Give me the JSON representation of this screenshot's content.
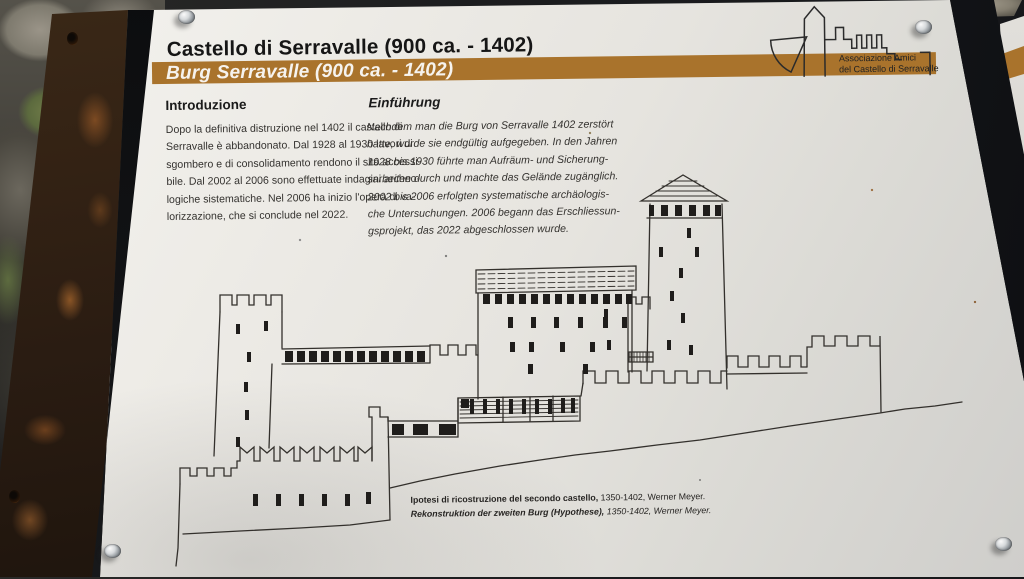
{
  "colors": {
    "accent_brown": "#a9732c",
    "panel_white": "#eceae5",
    "ink": "#1b1b1b"
  },
  "header": {
    "title_italian": "Castello di Serravalle (900 ca. - 1402)",
    "title_german": "Burg Serravalle (900 ca. - 1402)"
  },
  "logo": {
    "line1": "Associazione Amici",
    "line2": "del Castello di Serravalle"
  },
  "intro_it": {
    "heading": "Introduzione",
    "lines": [
      "Dopo la definitiva distruzione nel 1402 il castello di",
      "Serravalle è abbandonato. Dal 1928 al 1930 lavori di",
      "sgombero e di consolidamento rendono il sito accessi-",
      "bile. Dal 2002 al 2006 sono effettuate indagini archeo-",
      "logiche sistematiche. Nel 2006 ha inizio l'opera di va-",
      "lorizzazione, che si conclude nel 2022."
    ]
  },
  "intro_de": {
    "heading": "Einführung",
    "lines": [
      "Nachdem man die Burg von Serravalle 1402 zerstört",
      "hatte, wurde sie endgültig aufgegeben. In den Jahren",
      "1928 bis 1930 führte man Aufräum- und Sicherung-",
      "sarbeiten durch und machte das Gelände zugänglich.",
      "2002 bis 2006 erfolgten systematische archäologis-",
      "che Untersuchungen. 2006 begann das Erschliessun-",
      "gsprojekt, das 2022 abgeschlossen wurde."
    ]
  },
  "caption": {
    "it_bold": "Ipotesi di ricostruzione del secondo castello,",
    "it_rest": " 1350-1402, Werner Meyer.",
    "de_bold": "Rekonstruktion der zweiten Burg (Hypothese),",
    "de_rest": " 1350-1402, Werner Meyer."
  },
  "drawing": {
    "subject": "Line reconstruction drawing of the second castle of Serravalle (towers, crenellated walls, keep with pyramidal roof) on sloping terrain"
  }
}
